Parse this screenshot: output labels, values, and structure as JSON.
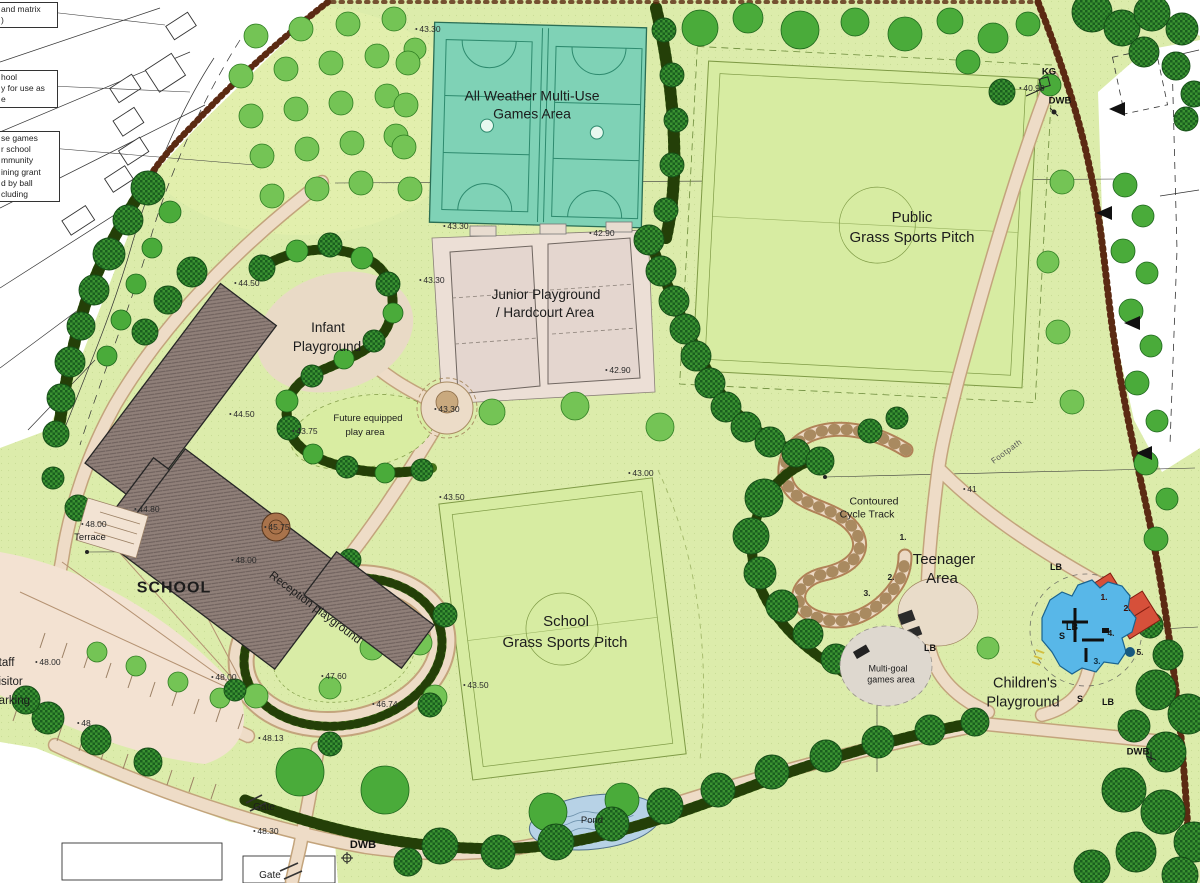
{
  "plan": {
    "areas": {
      "muga_l1": "All Weather Multi-Use",
      "muga_l2": "Games Area",
      "junior_l1": "Junior Playground",
      "junior_l2": "/ Hardcourt Area",
      "public_l1": "Public",
      "public_l2": "Grass Sports Pitch",
      "school": "SCHOOL",
      "infant_l1": "Infant",
      "infant_l2": "Playground",
      "future_l1": "Future equipped",
      "future_l2": "play area",
      "terrace": "Terrace",
      "reception": "Reception playground",
      "school_pitch_l1": "School",
      "school_pitch_l2": "Grass Sports Pitch",
      "cycle_l1": "Contoured",
      "cycle_l2": "Cycle Track",
      "teen_l1": "Teenager",
      "teen_l2": "Area",
      "multigoal_l1": "Multi-goal",
      "multigoal_l2": "games area",
      "childrens_l1": "Children's",
      "childrens_l2": "Playground",
      "pond": "Pond",
      "parking_l1": "Staff",
      "parking_l2": "Visitor",
      "parking_l3": "Parking",
      "footpath": "Footpath"
    },
    "markers": {
      "gate": "Gate",
      "dwb": "DWB",
      "kg": "KG",
      "lb": "LB",
      "s": "S"
    },
    "levels": {
      "v4330": "43.30",
      "v4290": "42.90",
      "v4450": "44.50",
      "v4375": "43.75",
      "v4480": "44.80",
      "v4575": "45.75",
      "v4800": "48.00",
      "v4760": "47.60",
      "v4674": "46.74",
      "v4813": "48.13",
      "v4350": "43.50",
      "v4300": "43.00",
      "v4830": "48.30",
      "v4090": "40.90",
      "v48": "48",
      "v41": "41"
    },
    "sequence": {
      "n1": "1.",
      "n2": "2.",
      "n3": "3.",
      "n4": "4.",
      "n5": "5."
    },
    "notes": {
      "n1_l1": "and matrix",
      "n1_l2": ")",
      "n2_l1": "hool",
      "n2_l2": "y for use as",
      "n2_l3": "e",
      "n3_l1": "se games",
      "n3_l2": "r school",
      "n3_l3": "mmunity",
      "n3_l4": "ining grant",
      "n3_l5": "d by ball",
      "n3_l6": "cluding"
    },
    "colors": {
      "field": "#dcecab",
      "muga": "#7fd2b6",
      "path": "#eedcc7",
      "building": "#8f7f78",
      "pond": "#b7d2e6",
      "play_blue": "#58b7e8",
      "play_red": "#d6503a",
      "boundary": "#5b2a13",
      "tree_dark": "#3a9231",
      "tree_light": "#74c455"
    }
  }
}
